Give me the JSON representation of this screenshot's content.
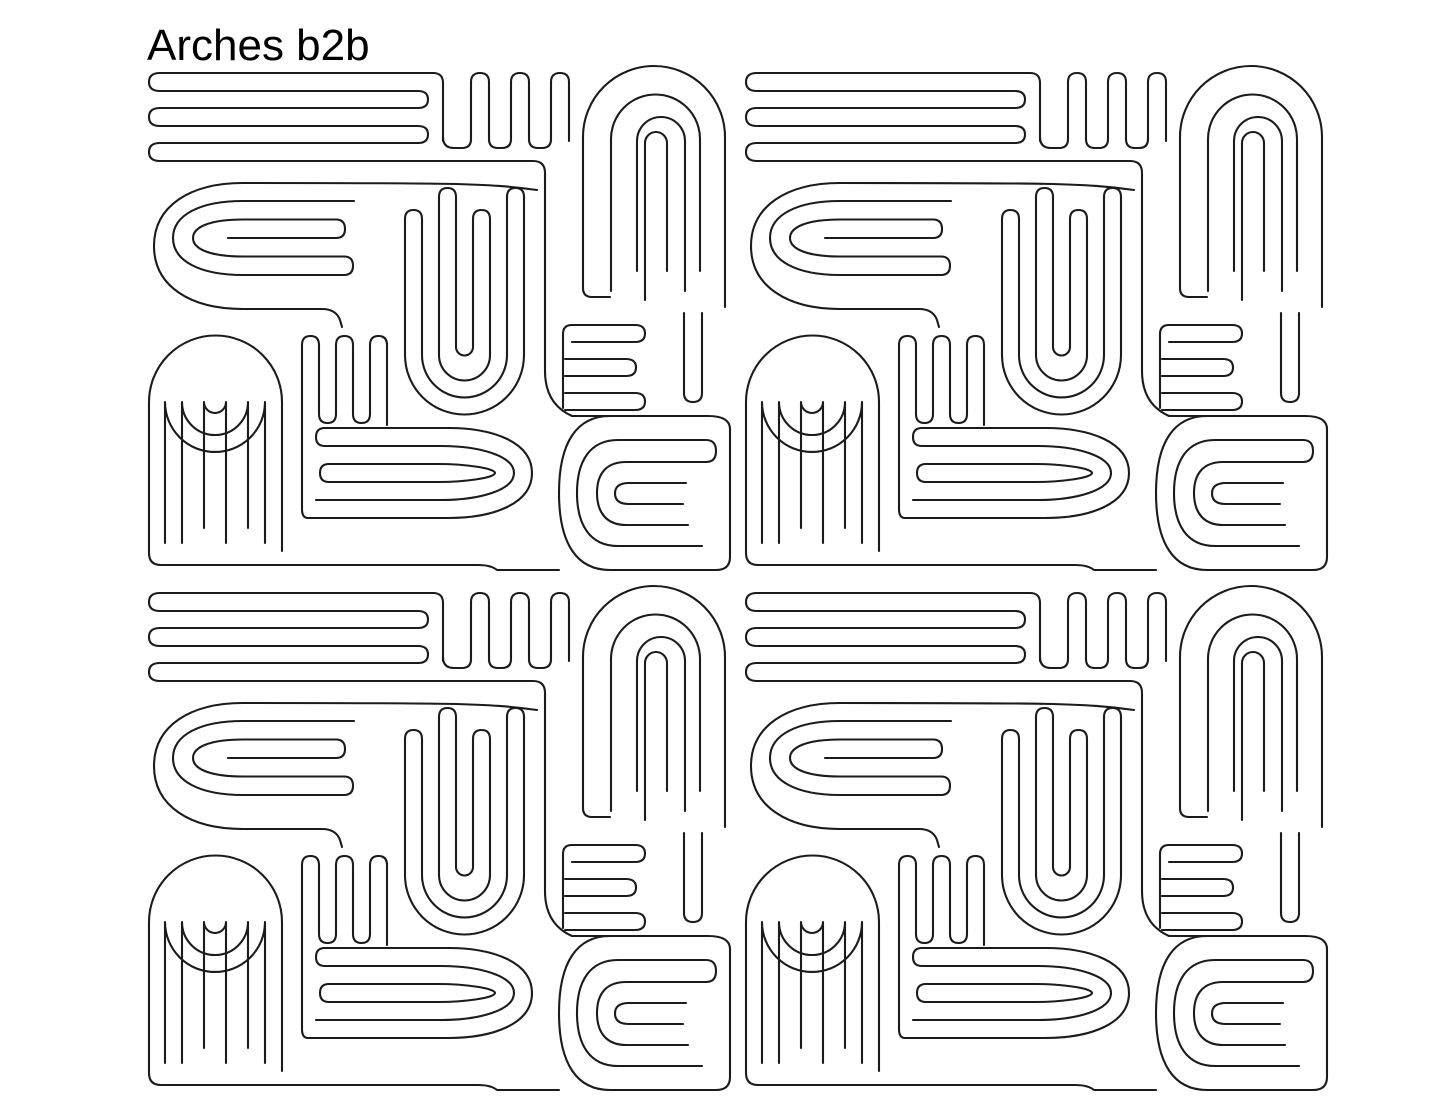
{
  "header": {
    "title": "Arches b2b"
  },
  "pattern": {
    "name": "Arches b2b",
    "tile_columns": 2,
    "tile_rows": 2,
    "motifs": [
      "stripe-serpentine",
      "upright-comb",
      "nested-arch",
      "g-spiral",
      "nested-u-cluster",
      "tall-arch",
      "vertical-comb",
      "nested-d",
      "e-comb",
      "e-spiral"
    ]
  },
  "colors": {
    "line": "#1b1b1b",
    "background": "#ffffff",
    "title_text": "#000000"
  }
}
